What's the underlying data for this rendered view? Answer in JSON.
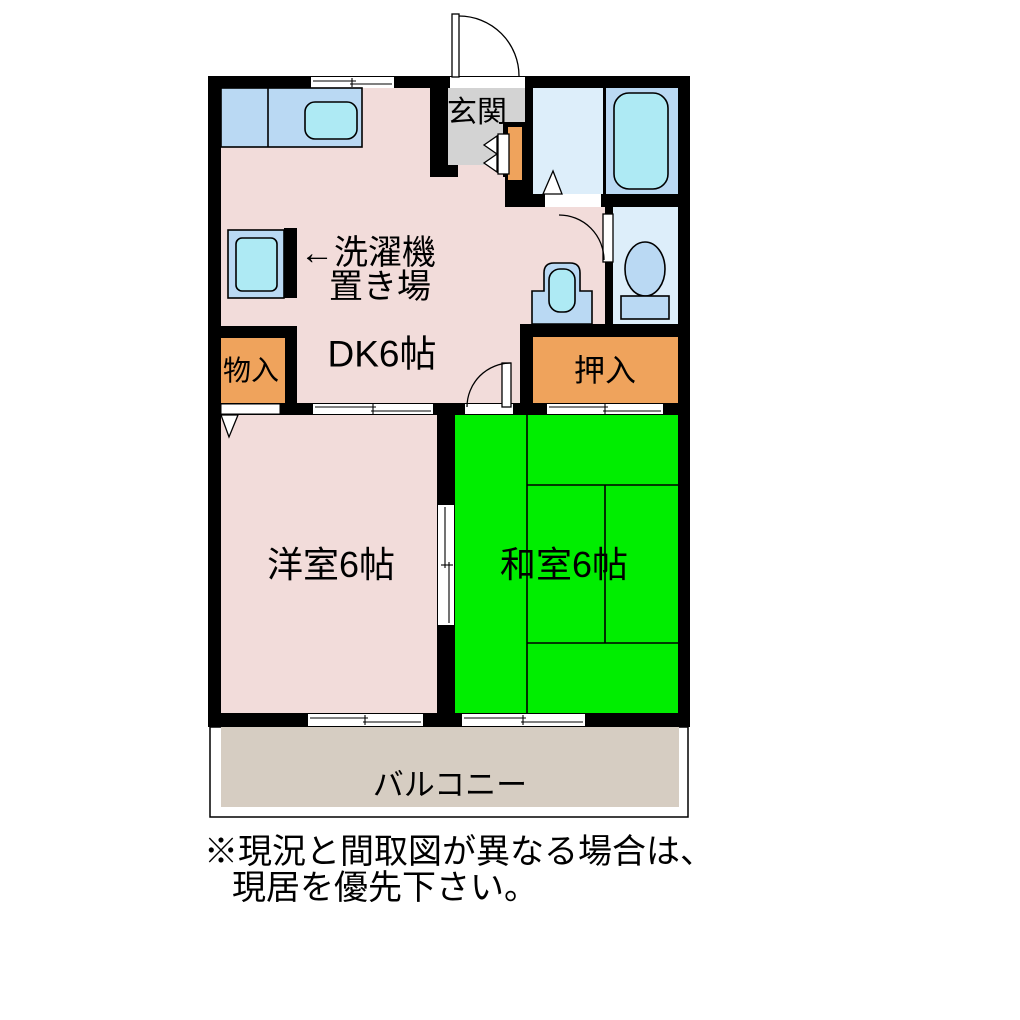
{
  "floor_plan": {
    "rooms": {
      "genkan": {
        "label": "玄関"
      },
      "dk": {
        "label": "DK6帖"
      },
      "washer": {
        "label_line1": "←洗濯機",
        "label_line2": "置き場"
      },
      "mono_iri": {
        "label": "物入"
      },
      "oshiire": {
        "label": "押入"
      },
      "yoshitsu": {
        "label": "洋室6帖"
      },
      "washitsu": {
        "label": "和室6帖"
      },
      "balcony": {
        "label": "バルコニー"
      }
    },
    "note": {
      "line1": "※現況と間取図が異なる場合は、",
      "line2": "現居を優先下さい。"
    },
    "colors": {
      "wall": "#000000",
      "pink": "#f2dcda",
      "green": "#00ee00",
      "orange": "#efa35c",
      "gray": "#d3d3d3",
      "waterBlue": "#bad9f3",
      "paleBlue": "#ddeefa",
      "cyan": "#aeeaf4",
      "beige": "#d6cdc2",
      "white": "#ffffff"
    }
  }
}
